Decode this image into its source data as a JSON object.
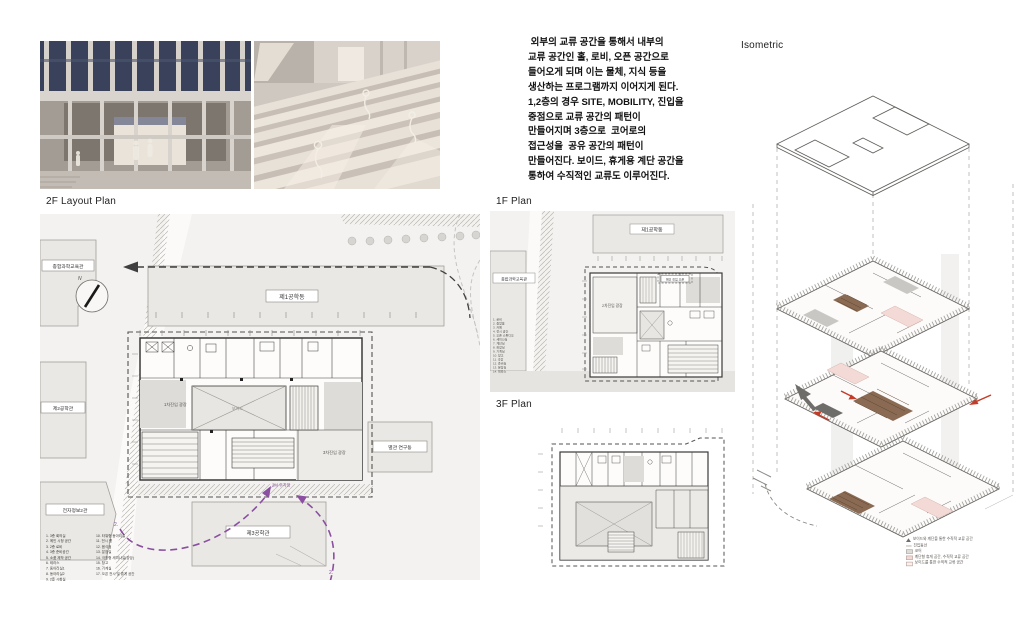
{
  "board": {
    "titles": {
      "plan2f": "2F Layout Plan",
      "plan1f": "1F Plan",
      "plan3f": "3F Plan",
      "isometric": "Isometric"
    }
  },
  "description": {
    "lines": [
      " 외부의 교류 공간을 통해서 내부의",
      "교류 공간인 홀, 로비, 오픈 공간으로",
      "들어오게 되며 이는 물체, 지식 등을",
      "생산하는 프로그램까지 이어지게 된다.",
      "1,2층의 경우 SITE, MOBILITY, 진입을",
      "중점으로 교류 공간의 패턴이",
      "만들어지며 3층으로  코어로의",
      "접근성을  공유 공간의 패턴이",
      "만들어진다. 보이드, 휴게용 계단 공간을",
      "통하여 수직적인 교류도 이루어진다."
    ]
  },
  "plan2f": {
    "compass_n": "N",
    "buildings": {
      "hall": "제1공학동",
      "edu": "종합과학교육관",
      "eng2": "제2공학관",
      "info": "전자정보2관",
      "eng3": "제3공학관",
      "annex": "별관 연구동"
    },
    "labels": {
      "plaza1": "1차진입 광장",
      "plaza3": "3차진입 광장",
      "void": "보이드",
      "parking": "2M 주차장",
      "arrow_left_no": "2.",
      "arrow_right_no": "2."
    },
    "legend_col1": [
      "1.   3층 회의실",
      "2.   메인 시청 공간",
      "3.   2층 로비",
      "4.   3층 준비공간",
      "5.   소품 제작 공간",
      "6.   테라스",
      "7.   동아리실1",
      "8.   동아리실2",
      "9.   2층 시청실"
    ],
    "legend_col2": [
      "10. 타워형 동아리실",
      "11. 전시 룸",
      "12. 음식점",
      "13. 분장실",
      "14. 극장형 세미나실(강당)",
      "15. 창고",
      "16. 기계실",
      "17. 오픈 전시 및 휴게 공간"
    ]
  },
  "plan1f": {
    "buildings": {
      "hall": "제1공학동",
      "edu": "종합과학교육관"
    },
    "labels": {
      "plaza2": "2차진입 광장",
      "entry": "메인 진입 오픈"
    },
    "legend_lines": [
      "1. 로비",
      "2. 중앙홀",
      "3. 카페",
      "4. 전시 공간",
      "5. 오픈 스튜디오",
      "6. 세미나실",
      "7. 계단실",
      "8. 화장실",
      "9. 기계실",
      "10. 창고",
      "11. 극장",
      "12. 준비실",
      "13. 분장실",
      "14. 테라스"
    ]
  },
  "iso_legend": {
    "items": [
      "보이드와 계단을 통한 수직적 교류 공간",
      "진입동선",
      "코어",
      "계단형 휴게 공간, 수직적 교류 공간",
      "보이드를 통한 수직적 교류 공간"
    ]
  },
  "colors": {
    "purple": "#8a4fa0",
    "red": "#c43c28",
    "pink": "#f3dad6",
    "brown": "#8a6a52"
  }
}
